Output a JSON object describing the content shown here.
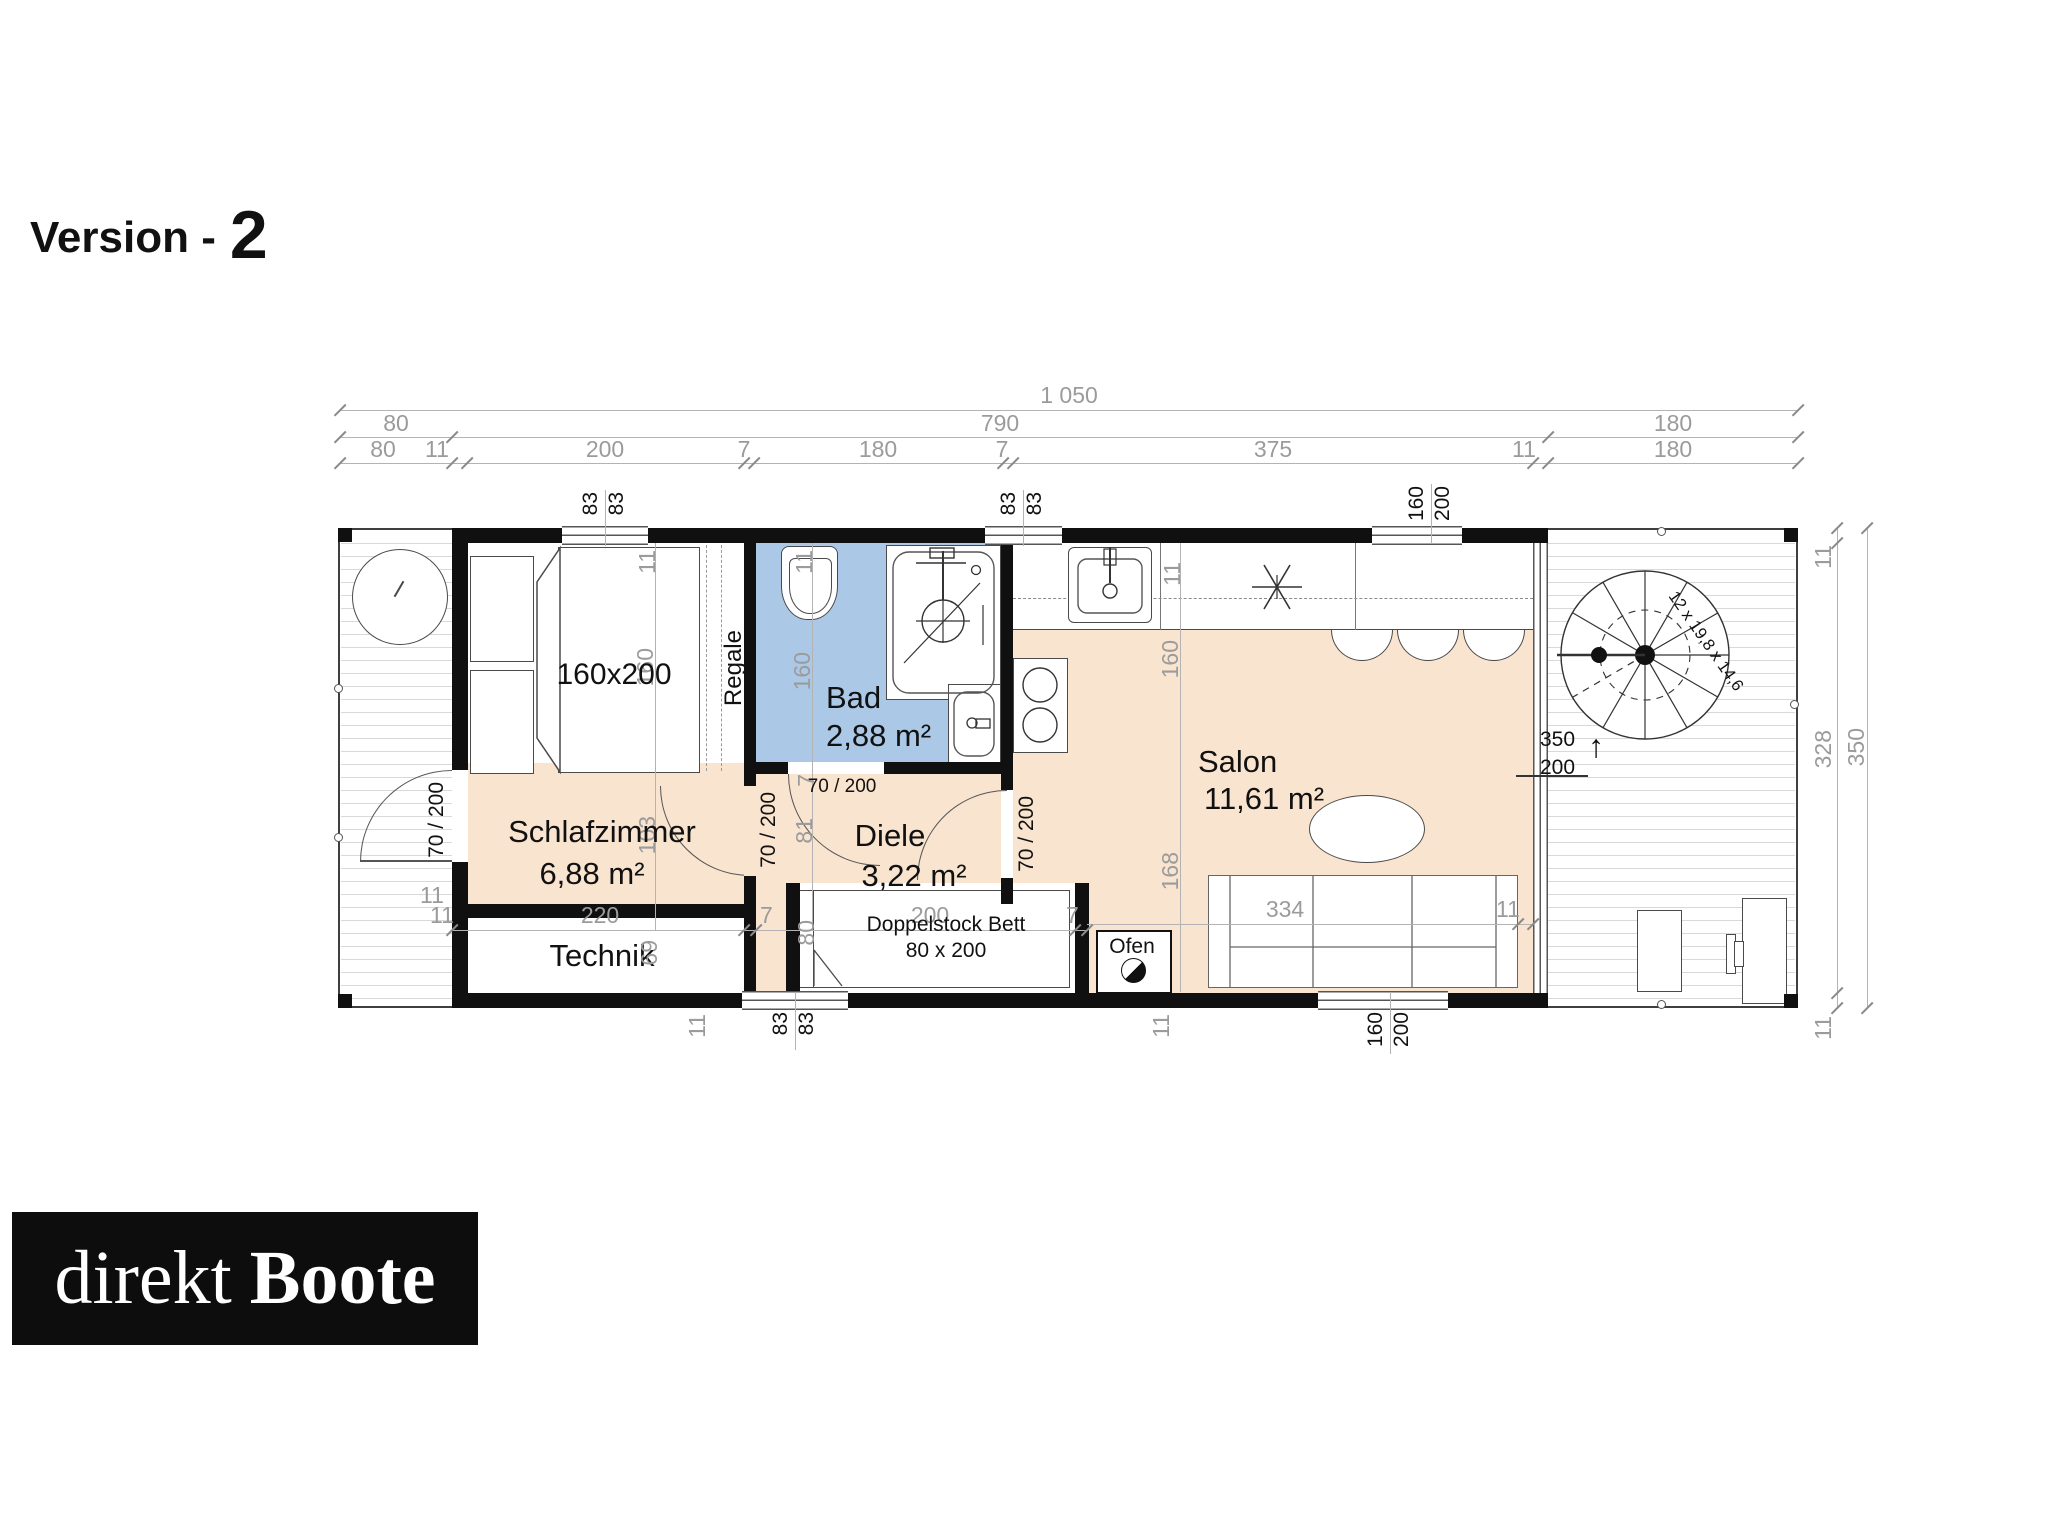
{
  "title": {
    "label": "Version -",
    "number": "2"
  },
  "logo": {
    "word1": "direkt",
    "word2": "Boote"
  },
  "colors": {
    "room_warm": "#f9e4cf",
    "room_bath": "#abc8e6",
    "wall": "#101010",
    "dim_text": "#9b9b9b"
  },
  "rooms": {
    "schlafzimmer": {
      "name": "Schlafzimmer",
      "area": "6,88 m²"
    },
    "bad": {
      "name": "Bad",
      "area": "2,88 m²"
    },
    "diele": {
      "name": "Diele",
      "area": "3,22 m²"
    },
    "salon": {
      "name": "Salon",
      "area": "11,61 m²"
    },
    "technik": {
      "name": "Technik"
    },
    "doppelstock": {
      "line1": "Doppelstock Bett",
      "line2": "80 x 200"
    },
    "ofen": {
      "name": "Ofen"
    },
    "regale": {
      "name": "Regale"
    },
    "bed": {
      "label": "160x200"
    }
  },
  "stair": {
    "label": "12 x 19,8 x 14,6"
  },
  "doors": {
    "label": "70 / 200"
  },
  "slider": {
    "width": "350",
    "height": "200"
  },
  "dims": {
    "total": "1 050",
    "row2": {
      "a": "80",
      "b": "790",
      "c": "180"
    },
    "row3": {
      "a": "80",
      "b": "11",
      "c": "200",
      "d": "7",
      "e": "180",
      "f": "7",
      "g": "375",
      "h": "11",
      "i": "180"
    },
    "right": {
      "top11": "11",
      "inner": "328",
      "outer": "350",
      "bottom11": "11"
    },
    "win_bed_top": {
      "a": "83",
      "b": "83"
    },
    "win_bad_top": {
      "a": "83",
      "b": "83"
    },
    "win_salon_top": {
      "a": "160",
      "b": "200"
    },
    "win_bett_bottom": {
      "a": "83",
      "b": "83"
    },
    "win_salon_bottom": {
      "a": "160",
      "b": "200"
    },
    "col_bedroom": {
      "t11": "11",
      "v160": "160",
      "v103": "103",
      "v69": "69"
    },
    "col_bad": {
      "t11": "11",
      "v160": "160",
      "w7": "7",
      "v81": "81",
      "v80": "80"
    },
    "col_salon": {
      "t11": "11",
      "v160": "160",
      "v168": "168"
    },
    "bottom_chain": {
      "a11": "11",
      "b220": "220",
      "c7": "7",
      "d200": "200",
      "e7": "7"
    },
    "sofa": {
      "len": "334",
      "wall": "11"
    },
    "deck_left_11": "11",
    "below11a": "11",
    "below11b": "11"
  }
}
